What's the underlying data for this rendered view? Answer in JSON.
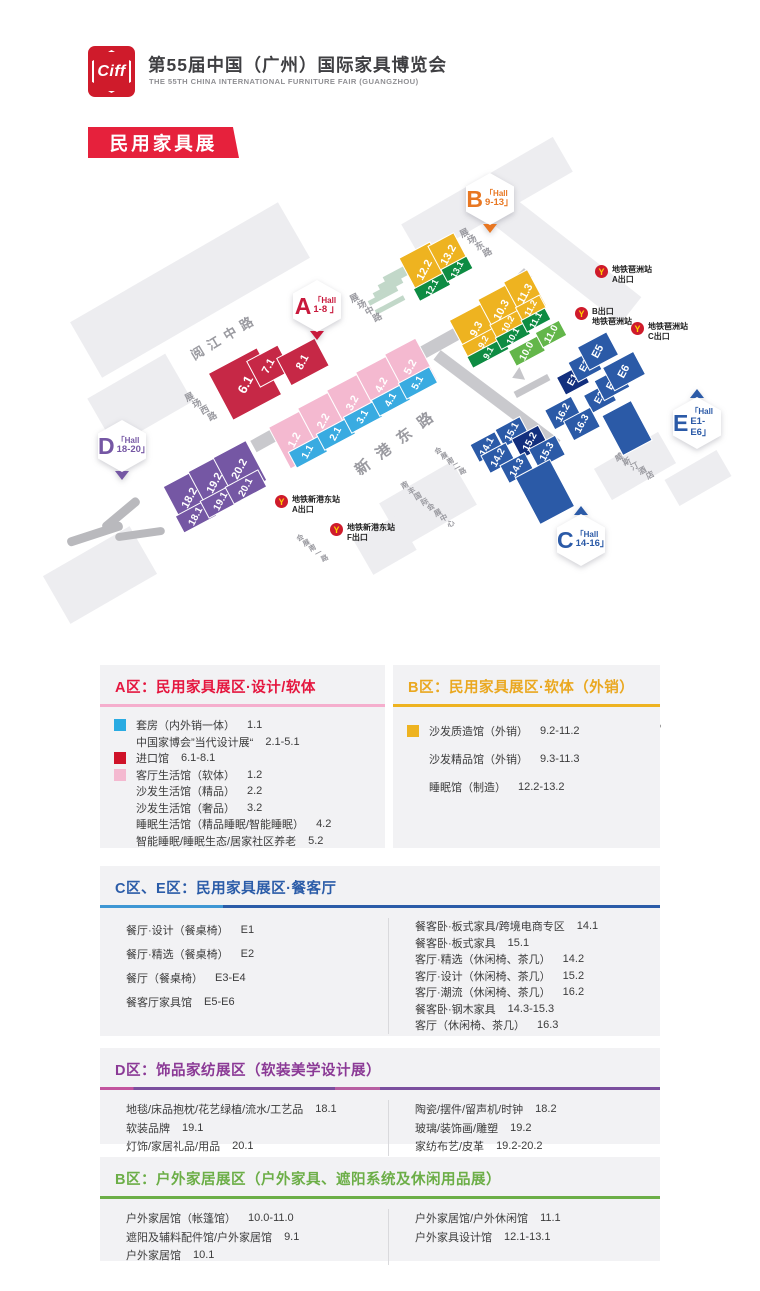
{
  "header": {
    "logo_text": "Ciff",
    "title": "第55届中国（广州）国际家具博览会",
    "subtitle": "THE 55TH CHINA INTERNATIONAL FURNITURE FAIR (GUANGZHOU)",
    "tag": "民用家具展"
  },
  "map": {
    "compass": "N",
    "area_colors": {
      "a_import": "#c62846",
      "a_soft": "#f4b9d0",
      "a_suite": "#39abe1",
      "b_sofa": "#eeb320",
      "outdoor_dark": "#0e8c43",
      "outdoor": "#63b64a",
      "ce": "#2b5aa7",
      "ce_dark": "#122f7e",
      "d": "#7557a4"
    },
    "halls": [
      {
        "key": "6.1",
        "label": "6.1",
        "area": "a_import"
      },
      {
        "key": "7.1",
        "label": "7.1",
        "area": "a_import"
      },
      {
        "key": "8.1",
        "label": "8.1",
        "area": "a_import"
      },
      {
        "key": "1.2",
        "label": "1.2",
        "area": "a_soft"
      },
      {
        "key": "2.2",
        "label": "2.2",
        "area": "a_soft"
      },
      {
        "key": "3.2",
        "label": "3.2",
        "area": "a_soft"
      },
      {
        "key": "4.2",
        "label": "4.2",
        "area": "a_soft"
      },
      {
        "key": "5.2",
        "label": "5.2",
        "area": "a_soft"
      },
      {
        "key": "1.1",
        "label": "1.1",
        "area": "a_suite"
      },
      {
        "key": "2.1",
        "label": "2.1",
        "area": "a_suite"
      },
      {
        "key": "3.1",
        "label": "3.1",
        "area": "a_suite"
      },
      {
        "key": "4.1",
        "label": "4.1",
        "area": "a_suite"
      },
      {
        "key": "5.1",
        "label": "5.1",
        "area": "a_suite"
      },
      {
        "key": "18.2",
        "label": "18.2",
        "area": "d"
      },
      {
        "key": "19.2",
        "label": "19.2",
        "area": "d"
      },
      {
        "key": "20.2",
        "label": "20.2",
        "area": "d"
      },
      {
        "key": "18.1",
        "label": "18.1",
        "area": "d"
      },
      {
        "key": "19.1",
        "label": "19.1",
        "area": "d"
      },
      {
        "key": "20.1",
        "label": "20.1",
        "area": "d"
      },
      {
        "key": "12.2",
        "label": "12.2",
        "area": "b_sofa"
      },
      {
        "key": "13.2",
        "label": "13.2",
        "area": "b_sofa"
      },
      {
        "key": "12.1",
        "label": "12.1",
        "area": "outdoor_dark"
      },
      {
        "key": "13.1",
        "label": "13.1",
        "area": "outdoor_dark"
      },
      {
        "key": "9.3",
        "label": "9.3",
        "area": "b_sofa"
      },
      {
        "key": "10.3",
        "label": "10.3",
        "area": "b_sofa"
      },
      {
        "key": "11.3",
        "label": "11.3",
        "area": "b_sofa"
      },
      {
        "key": "9.2",
        "label": "9.2",
        "area": "b_sofa"
      },
      {
        "key": "10.2",
        "label": "10.2",
        "area": "b_sofa"
      },
      {
        "key": "11.2",
        "label": "11.2",
        "area": "b_sofa"
      },
      {
        "key": "9.1",
        "label": "9.1",
        "area": "outdoor_dark"
      },
      {
        "key": "10.1",
        "label": "10.1",
        "area": "outdoor_dark"
      },
      {
        "key": "11.1",
        "label": "11.1",
        "area": "outdoor_dark"
      },
      {
        "key": "10.0",
        "label": "10.0",
        "area": "outdoor"
      },
      {
        "key": "11.0",
        "label": "11.0",
        "area": "outdoor"
      },
      {
        "key": "E1",
        "label": "E1",
        "area": "ce_dark"
      },
      {
        "key": "E3",
        "label": "E3",
        "area": "ce"
      },
      {
        "key": "E5",
        "label": "E5",
        "area": "ce"
      },
      {
        "key": "E2",
        "label": "E2",
        "area": "ce"
      },
      {
        "key": "E4",
        "label": "E4",
        "area": "ce"
      },
      {
        "key": "E6",
        "label": "E6",
        "area": "ce"
      },
      {
        "key": "14.1",
        "label": "14.1",
        "area": "ce"
      },
      {
        "key": "15.1",
        "label": "15.1",
        "area": "ce"
      },
      {
        "key": "14.2",
        "label": "14.2",
        "area": "ce"
      },
      {
        "key": "15.2",
        "label": "15.2",
        "area": "ce_dark"
      },
      {
        "key": "14.3",
        "label": "14.3",
        "area": "ce"
      },
      {
        "key": "15.3",
        "label": "15.3",
        "area": "ce"
      },
      {
        "key": "16.2",
        "label": "16.2",
        "area": "ce"
      },
      {
        "key": "16.3",
        "label": "16.3",
        "area": "ce"
      },
      {
        "key": "u1",
        "label": "",
        "area": "ce"
      },
      {
        "key": "u2",
        "label": "",
        "area": "ce"
      }
    ],
    "badges": [
      {
        "id": "A",
        "letter": "A",
        "hall_word": "「Hall",
        "hall_range": "1-8 」",
        "color": "#c8193c",
        "pointer": "down"
      },
      {
        "id": "B",
        "letter": "B",
        "hall_word": "「Hall",
        "hall_range": "9-13」",
        "color": "#e87722",
        "pointer": "down"
      },
      {
        "id": "D",
        "letter": "D",
        "hall_word": "「Hall",
        "hall_range": "18-20」",
        "color": "#7557a4",
        "pointer": "down"
      },
      {
        "id": "E",
        "letter": "E",
        "hall_word": "「Hall",
        "hall_range": "E1-E6」",
        "color": "#2b5aa7",
        "pointer": "up"
      },
      {
        "id": "C",
        "letter": "C",
        "hall_word": "「Hall",
        "hall_range": "14-16」",
        "color": "#2b5aa7",
        "pointer": "up"
      }
    ],
    "roads": [
      "阅江中路",
      "新港东路",
      "展场西路",
      "展场中路",
      "展场东路",
      "会展南二路",
      "会展南一路"
    ],
    "landmarks": [
      "南丰国际会展中心",
      "威斯汀酒店"
    ],
    "metro_stations": [
      {
        "id": "pazhou-a",
        "line1": "地铁琶洲站",
        "line2": "A出口"
      },
      {
        "id": "pazhou-b",
        "line1": "B出口",
        "line2": "地铁琶洲站"
      },
      {
        "id": "pazhou-c",
        "line1": "地铁琶洲站",
        "line2": "C出口"
      },
      {
        "id": "xingangdong-a",
        "line1": "地铁新港东站",
        "line2": "A出口"
      },
      {
        "id": "xingangdong-f",
        "line1": "地铁新港东站",
        "line2": "F出口"
      }
    ],
    "location": {
      "date": "2025年3月18-21日",
      "venue_line1": "广州琶洲·广交会展馆",
      "venue_line2": "保利世贸博览馆"
    }
  },
  "legend": {
    "panels": [
      {
        "id": "a",
        "title": "A区：民用家具展区·设计/软体",
        "title_color": "#e5173f",
        "underline": "#f5aecd",
        "swatch_slot": true,
        "row_h": 16.5,
        "columns": [
          [
            {
              "swatch": "#29abe2",
              "label": "套房（内外销一体）",
              "code": "1.1"
            },
            {
              "label": "中国家博会”当代设计展“",
              "code": "2.1-5.1"
            },
            {
              "swatch": "#cf1228",
              "label": "进口馆",
              "code": "6.1-8.1"
            },
            {
              "swatch": "#f4b9d0",
              "label": "客厅生活馆（软体）",
              "code": "1.2"
            },
            {
              "label": "沙发生活馆（精品）",
              "code": "2.2"
            },
            {
              "label": "沙发生活馆（奢品）",
              "code": "3.2"
            },
            {
              "label": "睡眠生活馆（精品睡眠/智能睡眠）",
              "code": "4.2"
            },
            {
              "label": "智能睡眠/睡眠生态/居家社区养老",
              "code": "5.2"
            }
          ]
        ]
      },
      {
        "id": "b",
        "title": "B区：民用家具展区·软体（外销）",
        "title_color": "#eaa820",
        "underline": "#eeb320",
        "swatch_slot": true,
        "row_h": 28,
        "columns": [
          [
            {
              "swatch": "#eeb320",
              "label": "沙发质造馆（外销）",
              "code": "9.2-11.2"
            },
            {
              "label": "沙发精品馆（外销）",
              "code": "9.3-11.3"
            },
            {
              "label": "睡眠馆（制造）",
              "code": "12.2-13.2"
            }
          ]
        ]
      },
      {
        "id": "ce",
        "title": "C区、E区：民用家具展区·餐客厅",
        "title_color": "#2b5ca8",
        "underline": "linear-gradient(to right,#3e97d4 0 22%,#2b5ca8 22%)",
        "swatch_slot": false,
        "row_h": 24,
        "row_h2": 16.5,
        "columns": [
          [
            {
              "label": "餐厅·设计（餐桌椅）",
              "code": "E1"
            },
            {
              "label": "餐厅·精选（餐桌椅）",
              "code": "E2"
            },
            {
              "label": "餐厅（餐桌椅）",
              "code": "E3-E4"
            },
            {
              "label": "餐客厅家具馆",
              "code": "E5-E6"
            }
          ],
          [
            {
              "label": "餐客卧·板式家具/跨境电商专区",
              "code": "14.1"
            },
            {
              "label": "餐客卧·板式家具",
              "code": "15.1"
            },
            {
              "label": "客厅·精选（休闲椅、茶几）",
              "code": "14.2"
            },
            {
              "label": "客厅·设计（休闲椅、茶几）",
              "code": "15.2"
            },
            {
              "label": "客厅·潮流（休闲椅、茶几）",
              "code": "16.2"
            },
            {
              "label": "餐客卧·钢木家具",
              "code": "14.3-15.3"
            },
            {
              "label": "客厅（休闲椅、茶几）",
              "code": "16.3"
            }
          ]
        ]
      },
      {
        "id": "d",
        "title": "D区：饰品家纺展区（软装美学设计展）",
        "title_color": "#8b3a96",
        "underline": "linear-gradient(to right,#c2549e 0 6%,#7b4f9e 6% 42%,#b75fa2 42% 50%,#7b4f9e 50%)",
        "swatch_slot": false,
        "row_h": 18.5,
        "columns": [
          [
            {
              "label": "地毯/床品抱枕/花艺绿植/流水/工艺品",
              "code": "18.1"
            },
            {
              "label": "软装品牌",
              "code": "19.1"
            },
            {
              "label": "灯饰/家居礼品/用品",
              "code": "20.1"
            }
          ],
          [
            {
              "label": "陶瓷/摆件/留声机/时钟",
              "code": "18.2"
            },
            {
              "label": "玻璃/装饰画/雕塑",
              "code": "19.2"
            },
            {
              "label": "家纺布艺/皮革",
              "code": "19.2-20.2"
            }
          ]
        ]
      },
      {
        "id": "b2",
        "title": "B区：户外家居展区（户外家具、遮阳系统及休闲用品展）",
        "title_color": "#6cae47",
        "underline": "#6cae47",
        "swatch_slot": false,
        "row_h": 18.5,
        "columns": [
          [
            {
              "label": "户外家居馆（帐篷馆）",
              "code": "10.0-11.0"
            },
            {
              "label": "遮阳及辅料配件馆/户外家居馆",
              "code": "9.1"
            },
            {
              "label": "户外家居馆",
              "code": "10.1"
            }
          ],
          [
            {
              "label": "户外家居馆/户外休闲馆",
              "code": "11.1"
            },
            {
              "label": "户外家具设计馆",
              "code": "12.1-13.1"
            }
          ]
        ]
      }
    ]
  }
}
